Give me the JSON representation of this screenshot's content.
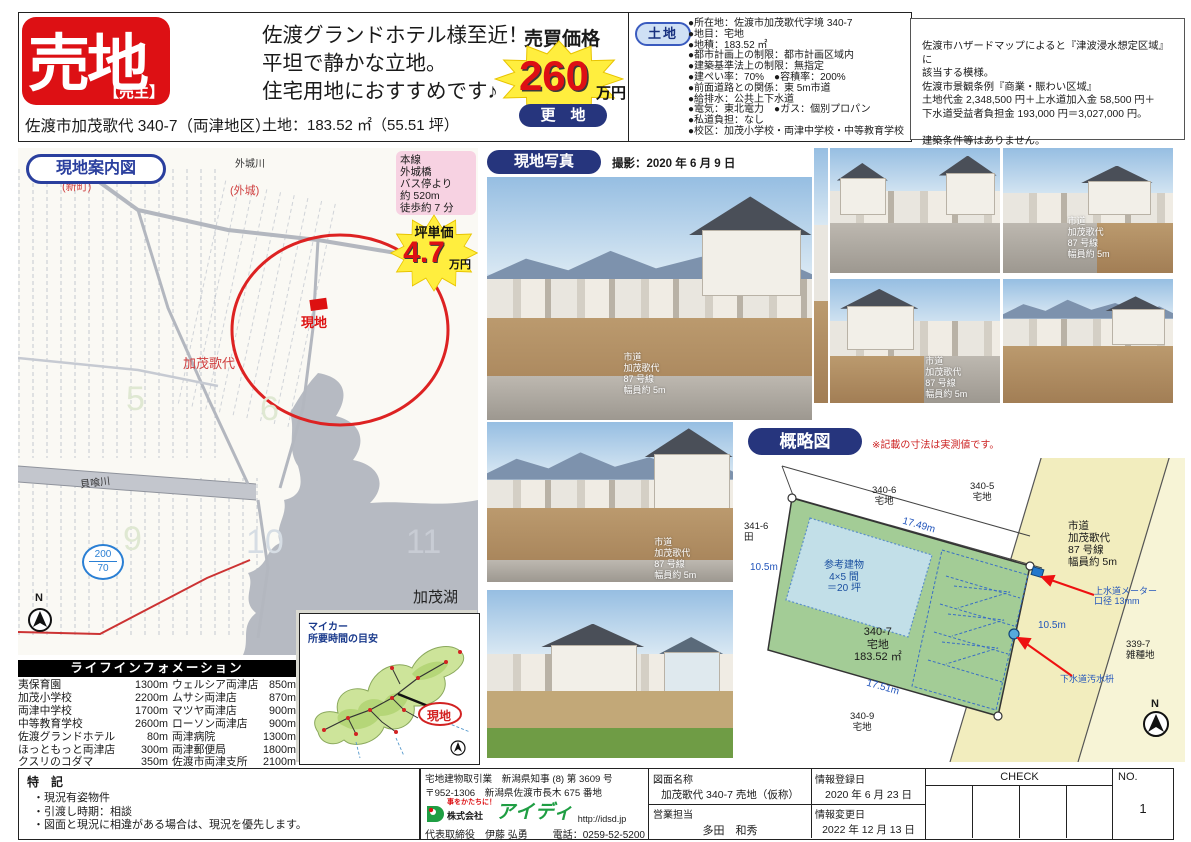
{
  "header": {
    "sale_badge": "売地",
    "seller_badge": "【売主】",
    "address": "佐渡市加茂歌代 340-7（両津地区）",
    "catchphrase": "佐渡グランドホテル様至近！\n平坦で静かな立地。\n住宅用地におすすめです♪",
    "land_area": "土地：183.52 ㎡（55.51 坪）",
    "price_label": "売買価格",
    "price_value": "260",
    "price_unit": "万円",
    "land_status": "更　地",
    "details_badge": "土地",
    "details": [
      "●所在地：佐渡市加茂歌代字境 340-7",
      "●地目：宅地",
      "●地積：183.52 ㎡",
      "●都市計画上の制限：都市計画区域内",
      "●建築基準法上の制限：無指定",
      "●建ぺい率：70%　●容積率：200%",
      "●前面道路との関係：東 5m市道",
      "●給排水：公共上下水道",
      "●電気：東北電力　●ガス：個別プロパン",
      "●私道負担：なし",
      "●校区：加茂小学校・両津中学校・中等教育学校"
    ],
    "notes": "佐渡市ハザードマップによると『津波浸水想定区域』に\n該当する模様。\n佐渡市景観条例『商業・賑わい区域』\n土地代金 2,348,500 円＋上水道加入金 58,500 円＋\n下水道受益者負担金 193,000 円＝3,027,000 円。\n\n建築条件等はありません。"
  },
  "map": {
    "title": "現地案内図",
    "bus_info": "本線\n外城橋\nバス停より\n約 520m\n徒歩約 7 分",
    "unit_price_label": "坪単価",
    "unit_price_value": "4.7",
    "unit_price_unit": "万円",
    "labels": {
      "shinmachi": "(新町)",
      "sotojiro_river": "外城川",
      "sotojiro": "(外城)",
      "site": "現地",
      "kamoutadai": "加茂歌代",
      "kaibami_river": "貝喰川",
      "route_top": "200",
      "route_bottom": "70",
      "lake": "加茂湖",
      "grid_numbers": [
        "5",
        "6",
        "9",
        "10",
        "11"
      ],
      "north": "N"
    }
  },
  "life_info": {
    "title": "ライフインフォメーション",
    "left": [
      {
        "name": "夷保育園",
        "dist": "1300m"
      },
      {
        "name": "加茂小学校",
        "dist": "2200m"
      },
      {
        "name": "両津中学校",
        "dist": "1700m"
      },
      {
        "name": "中等教育学校",
        "dist": "2600m"
      },
      {
        "name": "佐渡グランドホテル",
        "dist": "80m"
      },
      {
        "name": "ほっともっと両津店",
        "dist": "300m"
      },
      {
        "name": "クスリのコダマ",
        "dist": "350m"
      },
      {
        "name": "キングサンモール店",
        "dist": "700m"
      }
    ],
    "right": [
      {
        "name": "ウェルシア両津店",
        "dist": "850m"
      },
      {
        "name": "ムサシ両津店",
        "dist": "870m"
      },
      {
        "name": "マツヤ両津店",
        "dist": "900m"
      },
      {
        "name": "ローソン両津店",
        "dist": "900m"
      },
      {
        "name": "両津病院",
        "dist": "1300m"
      },
      {
        "name": "両津郵便局",
        "dist": "1800m"
      },
      {
        "name": "佐渡市両津支所",
        "dist": "2100m"
      },
      {
        "name": "佐渡汽船両津港",
        "dist": "2200m"
      }
    ]
  },
  "car_map": {
    "title": "マイカー\n所要時間の目安",
    "site_label": "現地"
  },
  "photos": {
    "title": "現地写真",
    "shot_date": "撮影：2020 年 6 月 9 日",
    "road_overlay": "市道\n加茂歌代\n87 号線\n幅員約 5m"
  },
  "sketch": {
    "title": "概略図",
    "note": "※記載の寸法は実測値です。",
    "parcel": "340-7\n宅地\n183.52 ㎡",
    "building": "参考建物\n4×5 間\n＝20 坪",
    "dim_top": "17.49m",
    "dim_bottom": "17.51m",
    "dim_left": "10.5m",
    "dim_right": "10.5m",
    "road": "市道\n加茂歌代\n87 号線\n幅員約 5m",
    "lot_340_6": "340-6\n宅地",
    "lot_340_5": "340-5\n宅地",
    "lot_341_6": "341-6\n田",
    "lot_340_9": "340-9\n宅地",
    "lot_339_7": "339-7\n雑種地",
    "water_meter": "上水道メーター\n口径 13mm",
    "sewer": "下水道汚水枡",
    "north": "N"
  },
  "footer": {
    "tokki_title": "特　記",
    "tokki_lines": [
      "・現況有姿物件",
      "・引渡し時期：相談",
      "・図面と現況に相違がある場合は、現況を優先します。"
    ],
    "company": {
      "license": "宅地建物取引業　新潟県知事 (8) 第 3609 号",
      "address": "〒952-1306　新潟県佐渡市長木 675 番地",
      "tagline": "事をかたちに！",
      "corp": "株式会社",
      "brand": "アイディ",
      "url": "http://idsd.jp",
      "rep": "代表取締役　伊藤 弘勇",
      "tel": "電話：0259-52-5200"
    },
    "drawing_label": "図面名称",
    "drawing_name": "加茂歌代 340-7 売地（仮称）",
    "sales_label": "営業担当",
    "sales_name": "多田　和秀",
    "reg_label": "情報登録日",
    "reg_date": "2020 年 6 月 23 日",
    "upd_label": "情報変更日",
    "upd_date": "2022 年 12 月 13 日",
    "check_label": "CHECK",
    "no_label": "NO.",
    "no_value": "1"
  }
}
